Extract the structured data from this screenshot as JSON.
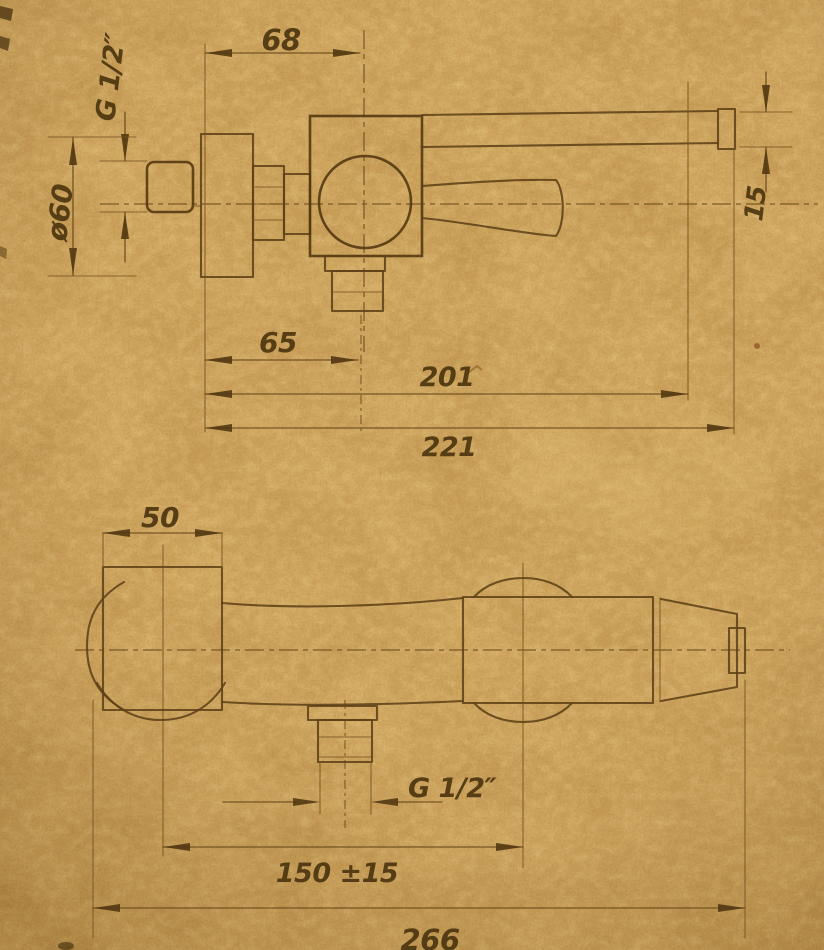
{
  "drawing": {
    "subject": "wall-mounted single-lever mixer tap, two orthographic views with dimensions",
    "paper_color": "#cfa35a",
    "line_color": "#5e4118",
    "text_color": "#4c350f",
    "side_view": {
      "dim_top_width": "68",
      "dim_inlet_thread": "G 1/2″",
      "dim_flange_diameter": "ø60",
      "dim_lever_thickness": "15",
      "dim_spout_offset": "65",
      "dim_lever_reach": "201",
      "dim_overall_depth": "221"
    },
    "front_view": {
      "dim_flange_width": "50",
      "dim_outlet_thread": "G 1/2″",
      "dim_connection_centers": "150 ±15",
      "dim_overall_width": "266"
    }
  }
}
